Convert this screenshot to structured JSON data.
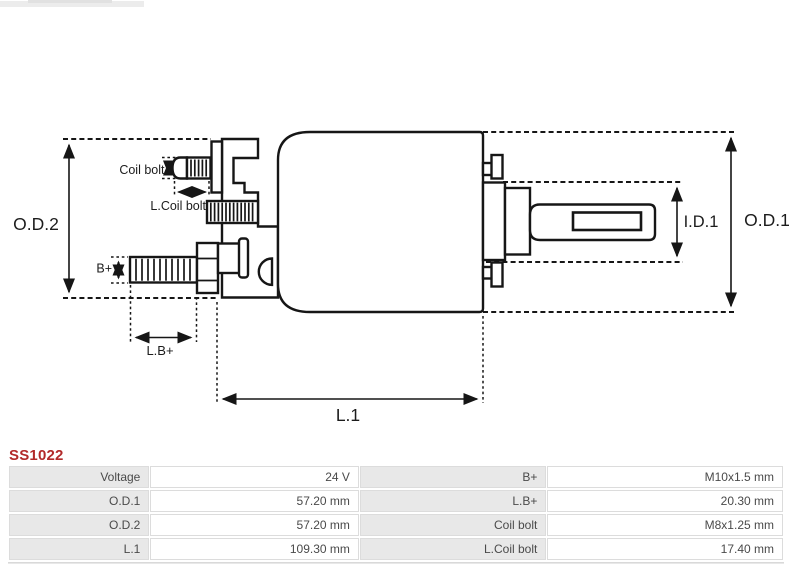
{
  "part_number": "SS1022",
  "colors": {
    "title_red": "#b22a2a",
    "line_black": "#161616",
    "table_label_bg": "#e8e8e8",
    "table_border": "#dcdcdc",
    "table_text": "#4a4a4a"
  },
  "diagram": {
    "labels": {
      "od2": "O.D.2",
      "od1": "O.D.1",
      "id1": "I.D.1",
      "l1": "L.1",
      "coil_bolt": "Coil bolt",
      "l_coil_bolt": "L.Coil bolt",
      "b_plus": "B+",
      "l_b_plus": "L.B+"
    }
  },
  "spec_table": {
    "rows": [
      {
        "c0": "Voltage",
        "c1": "24 V",
        "c2": "B+",
        "c3": "M10x1.5 mm"
      },
      {
        "c0": "O.D.1",
        "c1": "57.20 mm",
        "c2": "L.B+",
        "c3": "20.30 mm"
      },
      {
        "c0": "O.D.2",
        "c1": "57.20 mm",
        "c2": "Coil bolt",
        "c3": "M8x1.25 mm"
      },
      {
        "c0": "L.1",
        "c1": "109.30 mm",
        "c2": "L.Coil bolt",
        "c3": "17.40 mm"
      }
    ]
  }
}
